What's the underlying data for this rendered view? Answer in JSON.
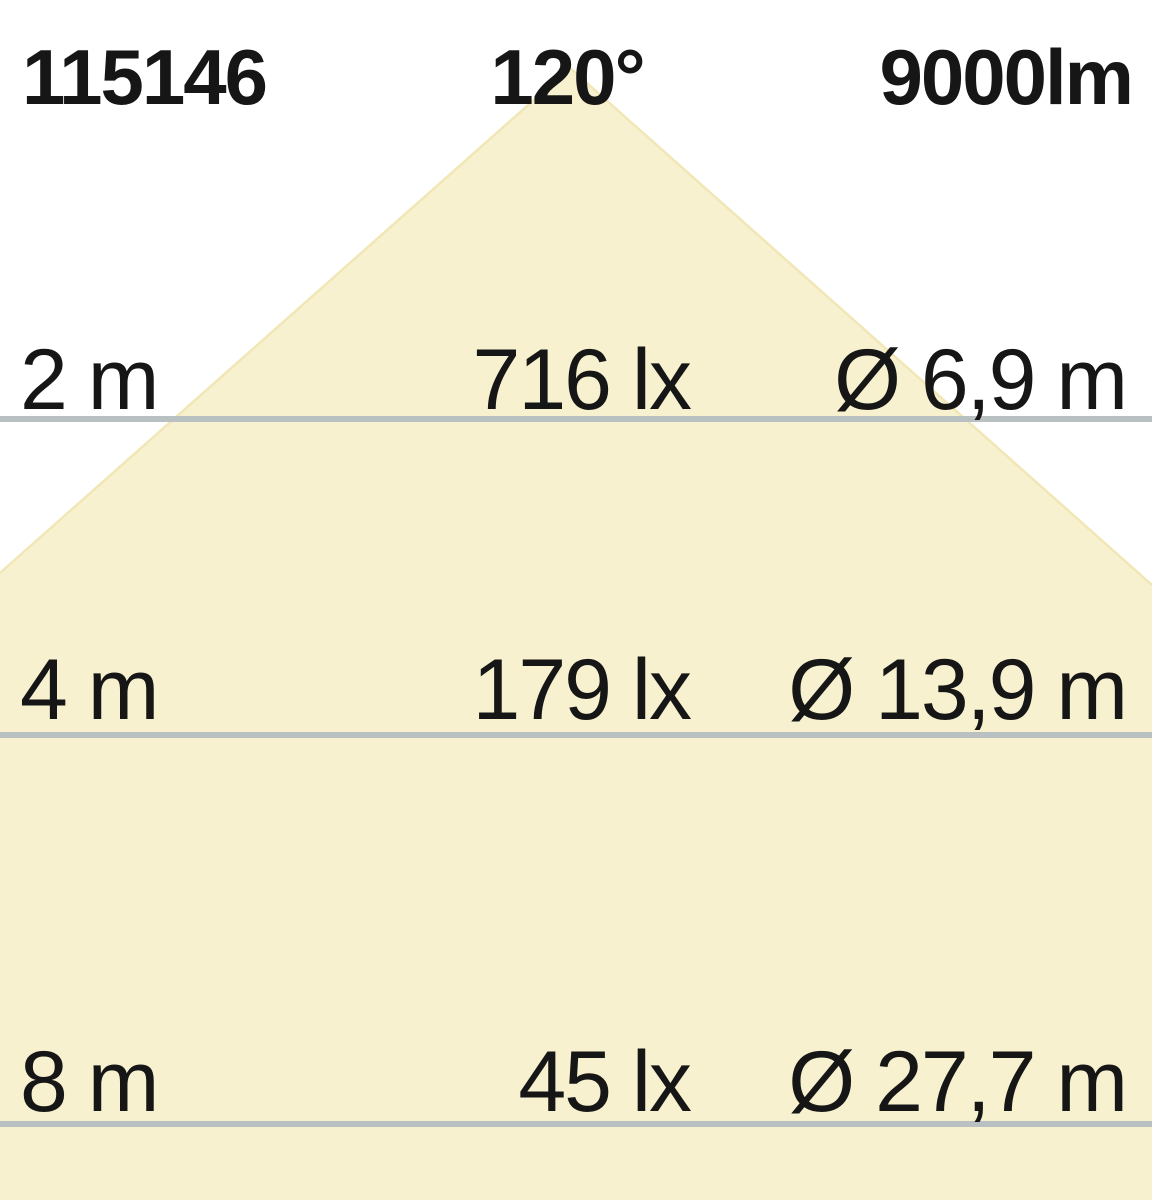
{
  "header": {
    "article_number": "115146",
    "beam_angle": "120°",
    "luminous_flux": "9000lm"
  },
  "rows": [
    {
      "distance": "2 m",
      "illuminance": "716 lx",
      "diameter": "Ø 6,9 m"
    },
    {
      "distance": "4 m",
      "illuminance": "179 lx",
      "diameter": "Ø 13,9 m"
    },
    {
      "distance": "8 m",
      "illuminance": "45 lx",
      "diameter": "Ø 27,7 m"
    }
  ],
  "colors": {
    "background": "#ffffff",
    "cone_fill": "#f7f1cf",
    "cone_edge": "#f1e7b6",
    "divider_line": "#b9c0c2",
    "text": "#161616"
  }
}
